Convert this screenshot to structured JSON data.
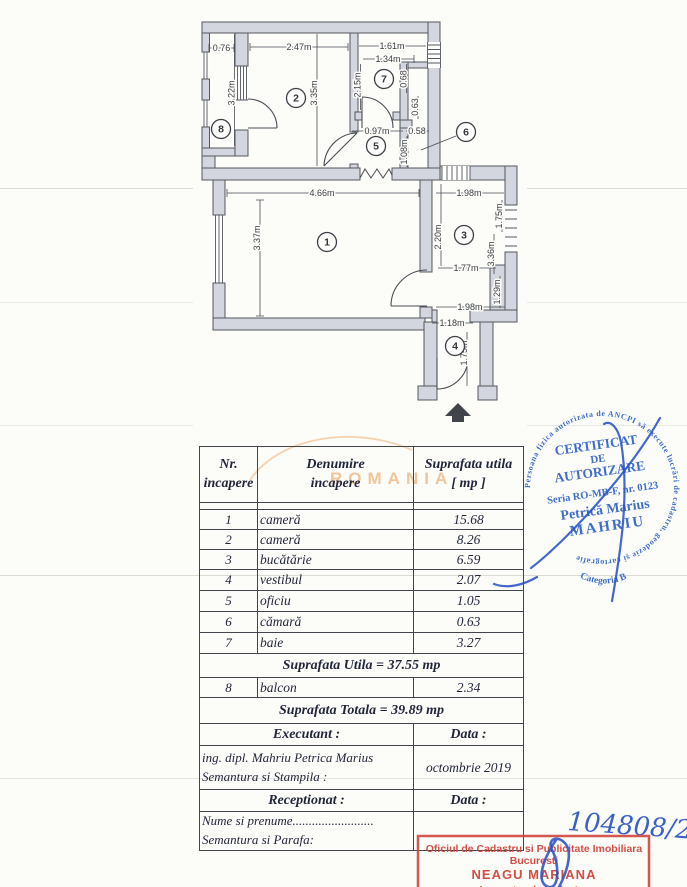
{
  "plan": {
    "rooms": {
      "r1": "1",
      "r2": "2",
      "r3": "3",
      "r4": "4",
      "r5": "5",
      "r6": "6",
      "r7": "7",
      "r8": "8"
    },
    "dims": {
      "balcony_width": "0.76",
      "balcony_length": "3.22m",
      "room2_width": "2.47m",
      "room2_height": "3.35m",
      "room7_width": "1.61m",
      "room7_inner_width": "1.34m",
      "room7_height": "2.15m",
      "nook_height": "0.68",
      "nook_width": "0.63",
      "room5_width": "0.97m",
      "room6_width": "0.58",
      "room6_height": "1.08m",
      "room1_width": "4.66m",
      "room1_height": "3.37m",
      "room3_top_width": "1.98m",
      "room3_left_height": "2.20m",
      "room3_right_height_a": "1.75m",
      "room3_right_height_b": "3.36m",
      "room3_mid_width": "1.77m",
      "room3_right_height_c": "1.29m",
      "room3_bottom_width": "1.98m",
      "room4_top_width": "1.18m",
      "room4_height": "1.75m"
    }
  },
  "table": {
    "header": {
      "col1_line1": "Nr.",
      "col1_line2": "incapere",
      "col2_line1": "Denumire",
      "col2_line2": "incapere",
      "col3_line1": "Suprafata utila",
      "col3_line2": "[ mp ]"
    },
    "rows": [
      {
        "nr": "1",
        "name": "cameră",
        "area": "15.68"
      },
      {
        "nr": "2",
        "name": "cameră",
        "area": "8.26"
      },
      {
        "nr": "3",
        "name": "bucătărie",
        "area": "6.59"
      },
      {
        "nr": "4",
        "name": "vestibul",
        "area": "2.07"
      },
      {
        "nr": "5",
        "name": "oficiu",
        "area": "1.05"
      },
      {
        "nr": "6",
        "name": "cămară",
        "area": "0.63"
      },
      {
        "nr": "7",
        "name": "baie",
        "area": "3.27"
      }
    ],
    "subtotal": "Suprafata Utila = 37.55 mp",
    "balcony": {
      "nr": "8",
      "name": "balcon",
      "area": "2.34"
    },
    "total": "Suprafata Totala = 39.89 mp",
    "executant_label": "Executant :",
    "executant_data_label": "Data :",
    "executant_line1": "ing. dipl. Mahriu Petrica Marius",
    "executant_line2": "Semantura si Stampila :",
    "executant_date": "octombrie 2019",
    "receptionat_label": "Receptionat :",
    "receptionat_data_label": "Data :",
    "receptionat_line1": "Nume si prenume.........................",
    "receptionat_line2": "Semantura si Parafa:"
  },
  "watermark": {
    "text": "ROMANIA",
    "color": "#eba966"
  },
  "round_stamp": {
    "ring": "Persoana fizica autorizata de ANCPI să execute lucrări de cadastru, geodezie și cartografie",
    "category": "Categoria B",
    "line1": "CERTIFICAT",
    "line2": "DE",
    "line3": "AUTORIZARE",
    "serial": "Seria RO-MB-F, nr. 0123",
    "name1": "Petrică Marius",
    "name2": "MAHRIU",
    "color": "#2f62c4"
  },
  "red_stamp": {
    "line1": "Oficiul de Cadastru si Publicitate Imobiliara",
    "line2": "Bucuresti",
    "line3": "NEAGU MARIANA",
    "line4": "Inspector de cadastru",
    "color": "#cf463c"
  },
  "annotations": {
    "file_number": "104808/2019",
    "ink_color": "#2a52c4"
  }
}
